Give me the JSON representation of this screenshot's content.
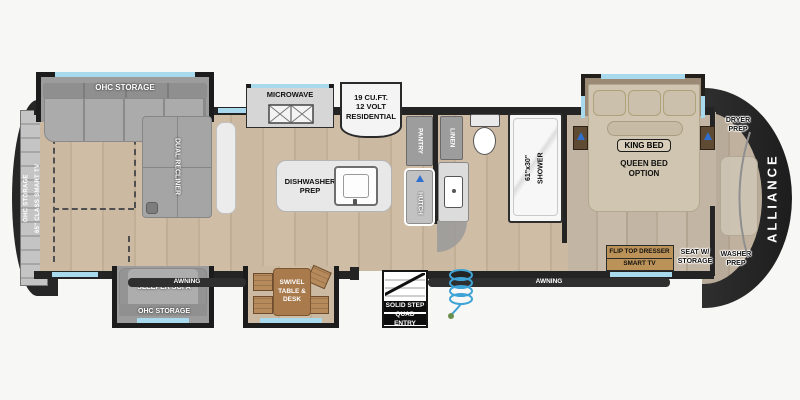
{
  "plan": {
    "brand": "ALLIANCE",
    "rear_entertainment": "OHC STORAGE\n65\" CLASS SMART TV",
    "sofa_slide": {
      "ohc": "OHC STORAGE",
      "recliner": "DUAL RECLINER"
    },
    "sleeper": {
      "sofa": "SLEEPER SOFA",
      "ohc": "OHC STORAGE"
    },
    "awning_left": "AWNING",
    "awning_right": "AWNING",
    "kitchen": {
      "microwave": "MICROWAVE",
      "fridge": "19 CU.FT.\n12 VOLT\nRESIDENTIAL",
      "island": "DISHWASHER\nPREP",
      "pantry": "PANTRY",
      "hutch": "HUTCH"
    },
    "dinette": "SWIVEL\nTABLE &\nDESK",
    "entry": {
      "line1": "SOLID STEP",
      "line2": "QUAD ENTRY"
    },
    "bath": {
      "linen": "LINEN",
      "shower": "61\"x30\"\nSHOWER"
    },
    "bedroom": {
      "king": "KING BED",
      "queen": "QUEEN BED\nOPTION",
      "dresser": "FLIP TOP DRESSER",
      "tv": "SMART TV",
      "seat": "SEAT W/\nSTORAGE",
      "dryer": "DRYER\nPREP",
      "washer": "WASHER\nPREP"
    }
  },
  "colors": {
    "wall": "#242424",
    "cap": "#262626",
    "floor_living": "#c8b69e",
    "floor_bedroom": "#c0b2a0",
    "window": "#a9d9ec",
    "sofa_gray": "#a8a8a8",
    "dresser_tan": "#bb9257",
    "fireplace_orange": "#f08c1e",
    "coil_blue": "#3fa3d6",
    "lamp_blue": "#2f6fd0"
  }
}
